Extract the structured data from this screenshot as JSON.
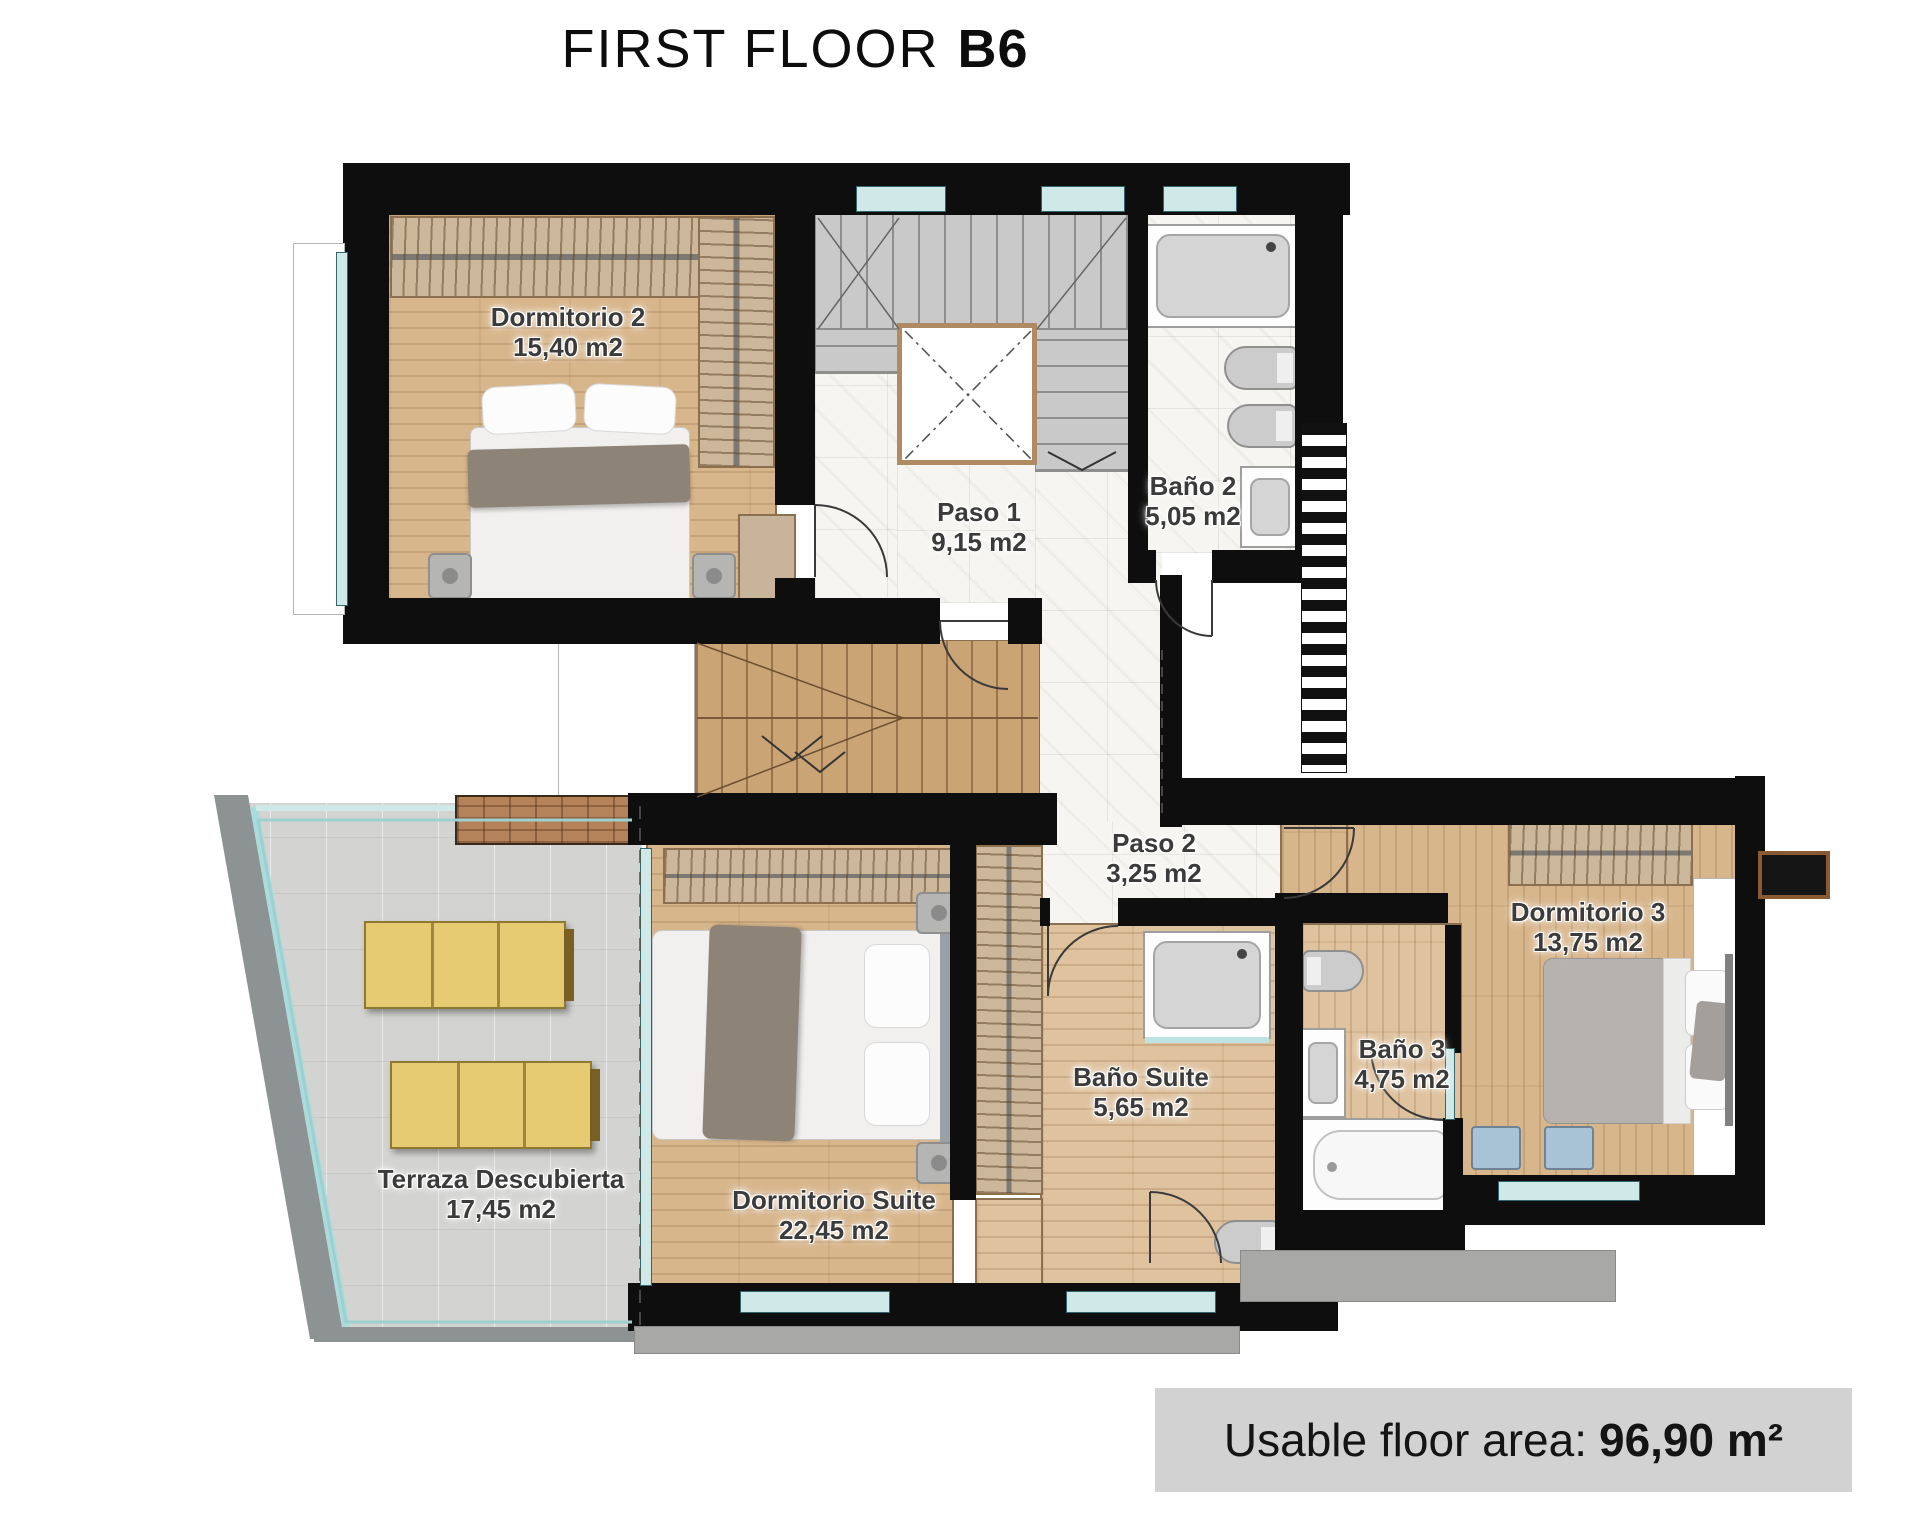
{
  "title": {
    "main": "FIRST FLOOR",
    "unit": "B6"
  },
  "rooms": [
    {
      "name": "Dormitorio 2",
      "area": "15,40 m2"
    },
    {
      "name": "Paso 1",
      "area": "9,15 m2"
    },
    {
      "name": "Baño 2",
      "area": "5,05 m2"
    },
    {
      "name": "Paso 2",
      "area": "3,25 m2"
    },
    {
      "name": "Dormitorio Suite",
      "area": "22,45 m2"
    },
    {
      "name": "Baño Suite",
      "area": "5,65 m2"
    },
    {
      "name": "Dormitorio 3",
      "area": "13,75 m2"
    },
    {
      "name": "Baño 3",
      "area": "4,75 m2"
    },
    {
      "name": "Terraza Descubierta",
      "area": "17,45 m2"
    }
  ],
  "footer": {
    "label": "Usable floor area:",
    "value": "96,90 m²"
  },
  "colors": {
    "wall": "#0e0e0e",
    "wood_floor": "#d8b68c",
    "marble_floor": "#f6f5f1",
    "terrace_tile": "#d3d3d1",
    "window_glass": "#cfe9e8",
    "lounger_yellow": "#e7cb72",
    "footer_bg": "#d2d2d2"
  }
}
